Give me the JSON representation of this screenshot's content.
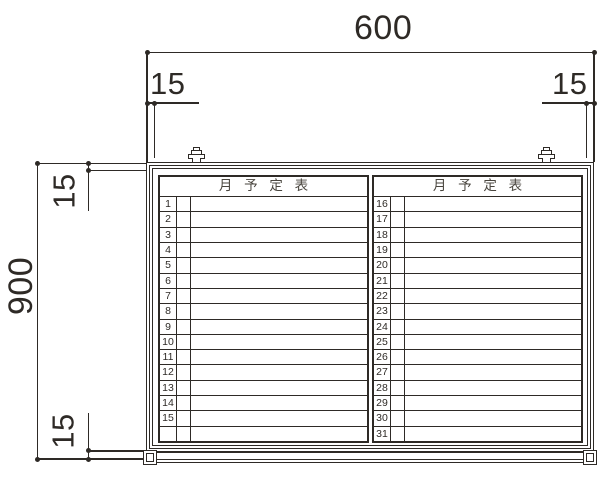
{
  "dims": {
    "width": "600",
    "height": "900",
    "margin_top_left": "15",
    "margin_top_right": "15",
    "margin_left_top": "15",
    "margin_left_bottom": "15"
  },
  "board": {
    "left_panel": {
      "header": "月 予 定 表",
      "rows": [
        "1",
        "2",
        "3",
        "4",
        "5",
        "6",
        "7",
        "8",
        "9",
        "10",
        "11",
        "12",
        "13",
        "14",
        "15",
        ""
      ]
    },
    "right_panel": {
      "header": "月 予 定 表",
      "rows": [
        "16",
        "17",
        "18",
        "19",
        "20",
        "21",
        "22",
        "23",
        "24",
        "25",
        "26",
        "27",
        "28",
        "29",
        "30",
        "31"
      ]
    }
  },
  "colors": {
    "line": "#2e2a26",
    "background": "#ffffff"
  }
}
